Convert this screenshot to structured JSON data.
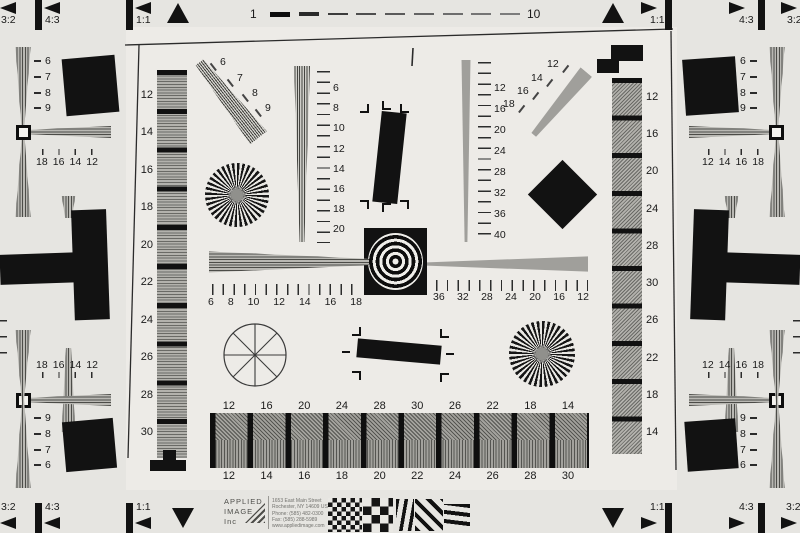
{
  "top_scale": {
    "start": "1",
    "end": "10"
  },
  "aspect_labels": {
    "a32": "3:2",
    "a43": "4:3",
    "a11": "1:1"
  },
  "edges": {
    "left_top_vertical": [
      "6",
      "7",
      "8",
      "9"
    ],
    "left_top_horizontal": [
      "18",
      "16",
      "14",
      "12"
    ],
    "left_bottom_horizontal": [
      "18",
      "16",
      "14",
      "12"
    ],
    "left_bottom_vertical": [
      "9",
      "8",
      "7",
      "6"
    ],
    "right_top_vertical": [
      "6",
      "7",
      "8",
      "9"
    ],
    "right_top_horizontal": [
      "12",
      "14",
      "16",
      "18"
    ],
    "right_bottom_horizontal": [
      "12",
      "14",
      "16",
      "18"
    ],
    "right_bottom_vertical": [
      "9",
      "8",
      "7",
      "6"
    ]
  },
  "columns": {
    "left_labels": [
      "12",
      "14",
      "16",
      "18",
      "20",
      "22",
      "24",
      "26",
      "28",
      "30"
    ],
    "right_labels": [
      "12",
      "16",
      "20",
      "24",
      "28",
      "30",
      "26",
      "22",
      "18",
      "14"
    ]
  },
  "rulers": {
    "fan_top_left": [
      "6",
      "7",
      "8",
      "9"
    ],
    "fan_top_right": [
      "12",
      "14",
      "16",
      "18"
    ],
    "vertical_left": [
      "6",
      "8",
      "10",
      "12",
      "14",
      "16",
      "18",
      "20"
    ],
    "vertical_right": [
      "12",
      "16",
      "20",
      "24",
      "28",
      "32",
      "36",
      "40"
    ],
    "horizontal_left": [
      "6",
      "8",
      "10",
      "12",
      "14",
      "16",
      "18"
    ],
    "horizontal_right": [
      "36",
      "32",
      "28",
      "24",
      "20",
      "16",
      "12"
    ]
  },
  "bottom_strip": {
    "top_labels": [
      "12",
      "16",
      "20",
      "24",
      "28",
      "30",
      "26",
      "22",
      "18",
      "14"
    ],
    "bottom_labels": [
      "12",
      "14",
      "16",
      "18",
      "20",
      "22",
      "24",
      "26",
      "28",
      "30"
    ]
  },
  "footer": {
    "brand": [
      "APPLIED",
      "IMAGE",
      "Inc"
    ],
    "address": [
      "1653 East Main Street",
      "Rochester, NY 14609 USA",
      "Phone: (585) 482-0300",
      "Fax: (585) 288-5989",
      "www.appliedimage.com"
    ]
  },
  "colors": {
    "background": "#e6e5e1",
    "inner": "#edebe7",
    "ink": "#121212",
    "gray": "#a09f9b"
  }
}
